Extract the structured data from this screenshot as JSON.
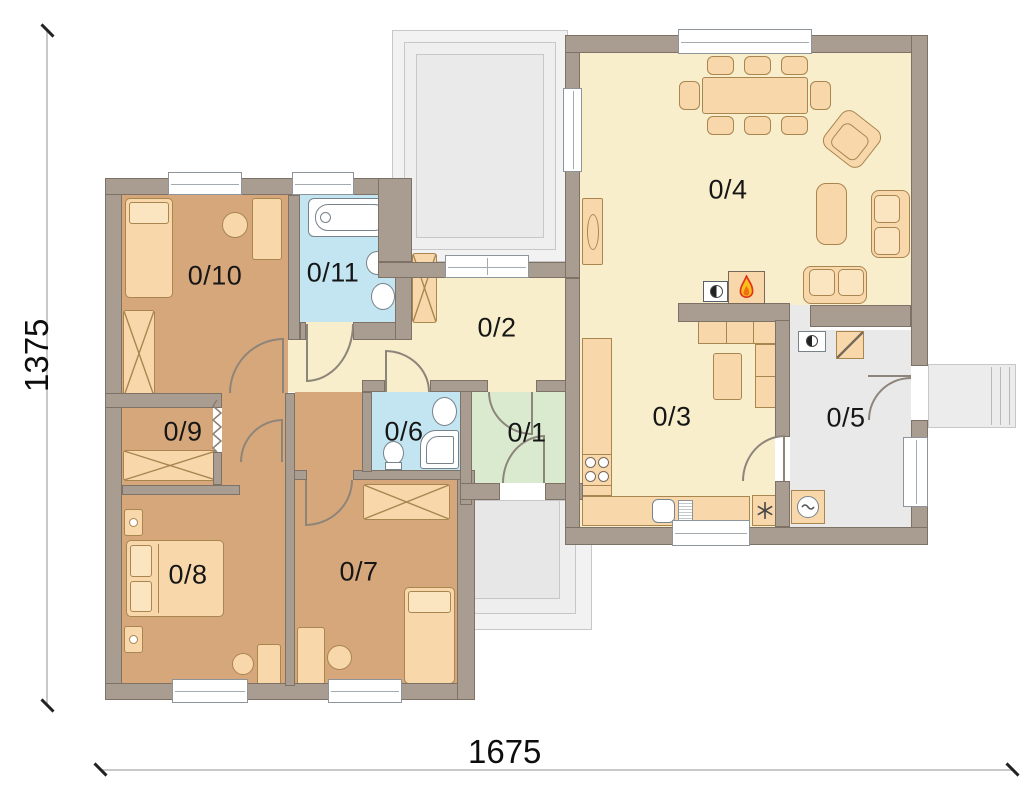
{
  "plan": {
    "type": "house-floor-plan",
    "rooms": [
      {
        "id": "0-1",
        "label": "0/1"
      },
      {
        "id": "0-2",
        "label": "0/2"
      },
      {
        "id": "0-3",
        "label": "0/3"
      },
      {
        "id": "0-4",
        "label": "0/4"
      },
      {
        "id": "0-5",
        "label": "0/5"
      },
      {
        "id": "0-6",
        "label": "0/6"
      },
      {
        "id": "0-7",
        "label": "0/7"
      },
      {
        "id": "0-8",
        "label": "0/8"
      },
      {
        "id": "0-9",
        "label": "0/9"
      },
      {
        "id": "0-10",
        "label": "0/10"
      },
      {
        "id": "0-11",
        "label": "0/11"
      }
    ],
    "dimensions": {
      "height": "1375",
      "width": "1675"
    },
    "colors": {
      "wall": "#a99c91",
      "bedroom_floor": "#d7a77c",
      "hallway_floor": "#f8eecb",
      "bathroom_floor": "#c3e5f1",
      "entry_floor": "#d9eacf",
      "utility_floor": "#e9e9e9",
      "furniture": "#f8d8ab",
      "terrace": "#f2f2f2",
      "flame_yellow": "#f9c01c",
      "flame_red": "#e03418"
    },
    "icons": [
      "flame-icon",
      "snowflake-icon",
      "wave-icon",
      "cross-wardrobe-icon"
    ]
  }
}
